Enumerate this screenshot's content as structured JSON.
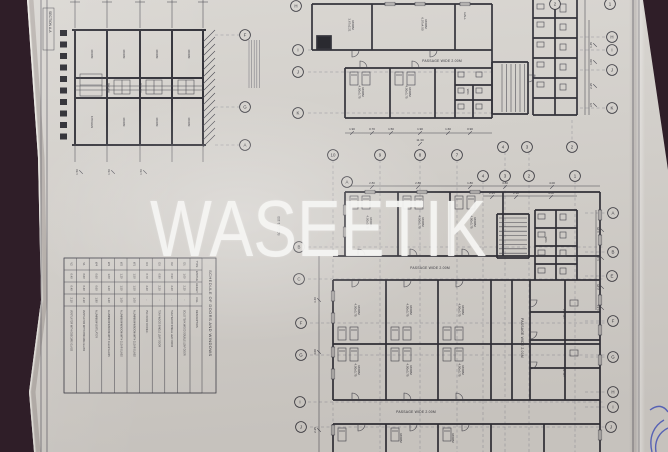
{
  "watermark": "WASEETIK",
  "colors": {
    "paper": "#d7d4cf",
    "ink": "#2c2c34",
    "wall": "#26262e",
    "background": "#2f1e28",
    "stamp_blue": "#2a3ec2",
    "watermark_white": "#f6f6f4"
  },
  "section": {
    "label": "SECTION A-A",
    "scale_note": "SCALE 1:100",
    "top_rooms": [
      "ROOM",
      "ROOM",
      "ROOM",
      "ROOM"
    ],
    "mid_rooms": [
      "PASSAGE",
      "PASSAGE"
    ],
    "bottom_rooms": [
      "KITCHEN",
      "ROOM",
      "ROOM",
      "ROOM"
    ],
    "col_dims": [
      "1.50",
      "1.50",
      "1.50"
    ]
  },
  "plans": {
    "passage_labels": [
      {
        "text": "PASSAGE WIDE 2.00M",
        "x": 442,
        "y": 62,
        "r": 0
      },
      {
        "text": "PASSAGE WIDE 2.00M",
        "x": 430,
        "y": 269,
        "r": 0
      },
      {
        "text": "PASSAGE WIDE 2.00M",
        "x": 416,
        "y": 413,
        "r": 0
      },
      {
        "text": "PASSAGE WIDE 2.00M",
        "x": 521,
        "y": 338,
        "r": 90
      }
    ],
    "room_labels": [
      {
        "name": "ROOM",
        "dims": "3.67x2.21",
        "x": 352,
        "y": 25
      },
      {
        "name": "ROOM",
        "dims": "6.07x4.50",
        "x": 425,
        "y": 24
      },
      {
        "name": "HALL",
        "dims": "",
        "x": 464,
        "y": 16
      },
      {
        "name": "ROOM",
        "dims": "4.00x3.75",
        "x": 362,
        "y": 92
      },
      {
        "name": "ROOM",
        "dims": "4.00x3.75",
        "x": 409,
        "y": 92
      },
      {
        "name": "W.C.",
        "dims": "",
        "x": 467,
        "y": 92
      },
      {
        "name": "ROOM",
        "dims": "4.00x3.75",
        "x": 370,
        "y": 222
      },
      {
        "name": "ROOM",
        "dims": "4.00x3.75",
        "x": 422,
        "y": 222
      },
      {
        "name": "ROOM",
        "dims": "4.00x3.75",
        "x": 474,
        "y": 222
      },
      {
        "name": "ROOM",
        "dims": "4.00x3.75",
        "x": 358,
        "y": 310
      },
      {
        "name": "ROOM",
        "dims": "4.00x3.75",
        "x": 410,
        "y": 310
      },
      {
        "name": "ROOM",
        "dims": "4.00x3.75",
        "x": 462,
        "y": 310
      },
      {
        "name": "ROOM",
        "dims": "4.00x3.75",
        "x": 358,
        "y": 370
      },
      {
        "name": "ROOM",
        "dims": "4.00x3.75",
        "x": 410,
        "y": 370
      },
      {
        "name": "ROOM",
        "dims": "4.00x3.75",
        "x": 462,
        "y": 370
      },
      {
        "name": "ROOM",
        "dims": "",
        "x": 400,
        "y": 438
      },
      {
        "name": "ROOM",
        "dims": "",
        "x": 452,
        "y": 438
      },
      {
        "name": "PNTRY",
        "dims": "",
        "x": 563,
        "y": 314
      },
      {
        "name": "PNTRY",
        "dims": "",
        "x": 563,
        "y": 372
      },
      {
        "name": "W.C.",
        "dims": "",
        "x": 545,
        "y": 240
      }
    ],
    "grid_bubbles": [
      {
        "label": "F",
        "x": 245,
        "y": 35
      },
      {
        "label": "G",
        "x": 245,
        "y": 107
      },
      {
        "label": "A",
        "x": 245,
        "y": 145
      },
      {
        "label": "H",
        "x": 296,
        "y": 6
      },
      {
        "label": "I",
        "x": 298,
        "y": 50
      },
      {
        "label": "J",
        "x": 298,
        "y": 72
      },
      {
        "label": "K",
        "x": 298,
        "y": 113
      },
      {
        "label": "10",
        "x": 333,
        "y": 155
      },
      {
        "label": "9",
        "x": 380,
        "y": 155
      },
      {
        "label": "8",
        "x": 420,
        "y": 155
      },
      {
        "label": "7",
        "x": 457,
        "y": 155
      },
      {
        "label": "A",
        "x": 347,
        "y": 182
      },
      {
        "label": "B",
        "x": 299,
        "y": 247
      },
      {
        "label": "C",
        "x": 299,
        "y": 279
      },
      {
        "label": "F",
        "x": 301,
        "y": 323
      },
      {
        "label": "G",
        "x": 301,
        "y": 355
      },
      {
        "label": "I",
        "x": 300,
        "y": 402
      },
      {
        "label": "J",
        "x": 301,
        "y": 427
      },
      {
        "label": "H",
        "x": 612,
        "y": 37
      },
      {
        "label": "I",
        "x": 612,
        "y": 50
      },
      {
        "label": "J",
        "x": 612,
        "y": 70
      },
      {
        "label": "K",
        "x": 612,
        "y": 108
      },
      {
        "label": "A",
        "x": 613,
        "y": 213
      },
      {
        "label": "B",
        "x": 613,
        "y": 252
      },
      {
        "label": "E",
        "x": 612,
        "y": 276
      },
      {
        "label": "F",
        "x": 613,
        "y": 321
      },
      {
        "label": "G",
        "x": 613,
        "y": 357
      },
      {
        "label": "H",
        "x": 613,
        "y": 392
      },
      {
        "label": "I",
        "x": 613,
        "y": 407
      },
      {
        "label": "J",
        "x": 611,
        "y": 427
      },
      {
        "label": "4",
        "x": 503,
        "y": 147
      },
      {
        "label": "3",
        "x": 527,
        "y": 147
      },
      {
        "label": "2",
        "x": 572,
        "y": 147
      },
      {
        "label": "4",
        "x": 483,
        "y": 176
      },
      {
        "label": "3",
        "x": 505,
        "y": 176
      },
      {
        "label": "2",
        "x": 529,
        "y": 176
      },
      {
        "label": "1",
        "x": 575,
        "y": 176
      },
      {
        "label": "2",
        "x": 555,
        "y": 4
      },
      {
        "label": "1",
        "x": 610,
        "y": 4
      }
    ],
    "dim_labels": [
      {
        "t": "1.90",
        "x": 352,
        "y": 130,
        "r": 0
      },
      {
        "t": "0.70",
        "x": 372,
        "y": 130,
        "r": 0
      },
      {
        "t": "1.50",
        "x": 391,
        "y": 130,
        "r": 0
      },
      {
        "t": "1.90",
        "x": 420,
        "y": 130,
        "r": 0
      },
      {
        "t": "1.60",
        "x": 448,
        "y": 130,
        "r": 0
      },
      {
        "t": "0.90",
        "x": 470,
        "y": 130,
        "r": 0
      },
      {
        "t": "11.30",
        "x": 420,
        "y": 141,
        "r": 0
      },
      {
        "t": "2.80",
        "x": 372,
        "y": 184,
        "r": 0
      },
      {
        "t": "2.80",
        "x": 418,
        "y": 184,
        "r": 0
      },
      {
        "t": "1.80",
        "x": 470,
        "y": 184,
        "r": 0
      },
      {
        "t": "3.80",
        "x": 505,
        "y": 184,
        "r": 0
      },
      {
        "t": "4.00",
        "x": 552,
        "y": 184,
        "r": 0
      },
      {
        "t": "2.25",
        "x": 492,
        "y": 194,
        "r": 0
      },
      {
        "t": "2.30",
        "x": 516,
        "y": 194,
        "r": 0
      },
      {
        "t": "4.00",
        "x": 551,
        "y": 194,
        "r": 0
      },
      {
        "t": "1.45",
        "x": 592,
        "y": 45,
        "r": -90
      },
      {
        "t": "1.00",
        "x": 592,
        "y": 62,
        "r": -90
      },
      {
        "t": "2.25",
        "x": 592,
        "y": 86,
        "r": -90
      },
      {
        "t": "3.5",
        "x": 592,
        "y": 105,
        "r": -90
      },
      {
        "t": "3.15",
        "x": 599,
        "y": 230,
        "r": -90
      },
      {
        "t": "1.20",
        "x": 599,
        "y": 258,
        "r": -90
      },
      {
        "t": "2.25",
        "x": 599,
        "y": 287,
        "r": -90
      },
      {
        "t": "3.44",
        "x": 599,
        "y": 308,
        "r": -90
      },
      {
        "t": "3.40",
        "x": 316,
        "y": 300,
        "r": -90
      },
      {
        "t": "4.00",
        "x": 316,
        "y": 352,
        "r": -90
      },
      {
        "t": "2.25",
        "x": 316,
        "y": 430,
        "r": -90
      },
      {
        "t": "1.50",
        "x": 78,
        "y": 172,
        "r": -90
      },
      {
        "t": "1.50",
        "x": 110,
        "y": 172,
        "r": -90
      },
      {
        "t": "1.50",
        "x": 142,
        "y": 172,
        "r": -90
      }
    ]
  },
  "schedule": {
    "title": "SCHEDULE OF DOORS AND WINDOWS",
    "headers": [
      "TYPE",
      "WIDTHE",
      "HEIGHT",
      "CILL",
      "DESCRIPTION"
    ],
    "rows": [
      {
        "type": "D1",
        "width": "1.00",
        "height": "2.20",
        "cill": "-",
        "desc": "SOLID TEAK WOOD DOUBLE LEAF DOOR"
      },
      {
        "type": "D2",
        "width": "0.90",
        "height": "2.20",
        "cill": "-",
        "desc": "TEAK WOOD SINGLE LEAF DOOR"
      },
      {
        "type": "D3",
        "width": "0.80",
        "height": "2.20",
        "cill": "-",
        "desc": "TEAK WOOD SINGLE LEAF DOOR"
      },
      {
        "type": "D4",
        "width": "0.70",
        "height": "2.20",
        "cill": "-",
        "desc": "PVC DOOR FOR W.C."
      },
      {
        "type": "W1",
        "width": "1.50",
        "height": "1.50",
        "cill": "1.00",
        "desc": "ALUMINIUM WINDOW WITH CLEAR GLASS"
      },
      {
        "type": "W2",
        "width": "1.20",
        "height": "1.50",
        "cill": "1.00",
        "desc": "ALUMINIUM WINDOW WITH CLEAR GLASS"
      },
      {
        "type": "W3",
        "width": "1.00",
        "height": "1.20",
        "cill": "1.20",
        "desc": "ALUMINIUM WINDOW WITH CLEAR GLASS"
      },
      {
        "type": "W4",
        "width": "0.60",
        "height": "0.60",
        "cill": "1.80",
        "desc": "ALUMINIUM VENTILATOR"
      },
      {
        "type": "V1",
        "width": "0.60",
        "height": "0.40",
        "cill": "2.10",
        "desc": "VENTILATOR WITH OBSCURE GLASS"
      },
      {
        "type": "V2",
        "width": "0.40",
        "height": "0.40",
        "cill": "2.10",
        "desc": "VENTILATOR WITH OBSCURE GLASS"
      }
    ]
  }
}
